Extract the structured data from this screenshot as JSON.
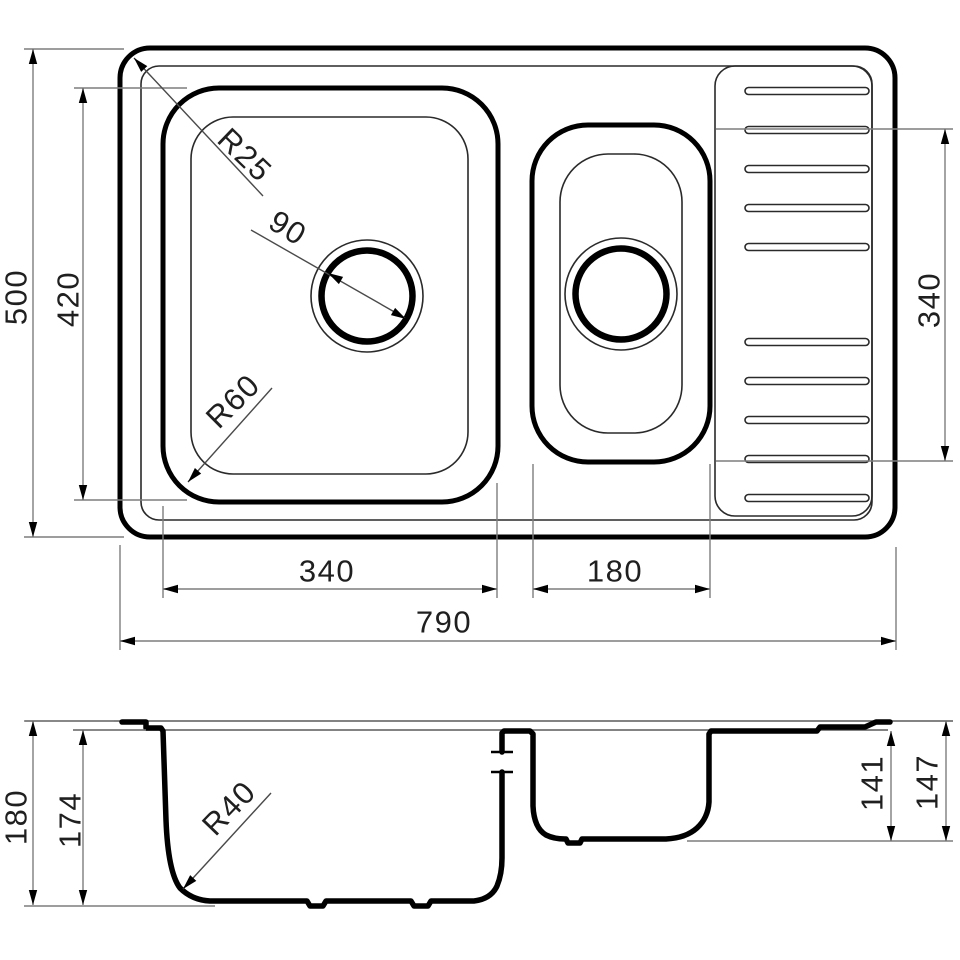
{
  "plan_view": {
    "dim_depth_overall": "500",
    "dim_depth_bowl": "420",
    "dim_width_main_bowl": "340",
    "dim_width_small_bowl": "180",
    "dim_width_overall": "790",
    "dim_drainboard_length": "340",
    "callout_rim_corner_radius": "R25",
    "callout_drain_diameter": "90",
    "callout_bowl_corner_radius": "R60"
  },
  "section_view": {
    "dim_height_overall": "180",
    "dim_depth_main_bowl": "174",
    "dim_depth_small_bowl": "141",
    "dim_height_small_bowl": "147",
    "callout_bowl_bottom_radius": "R40"
  },
  "colors": {
    "line": "#000000",
    "dimension_line": "#7d7d7d",
    "text": "#1f1f1f",
    "background": "#ffffff"
  }
}
